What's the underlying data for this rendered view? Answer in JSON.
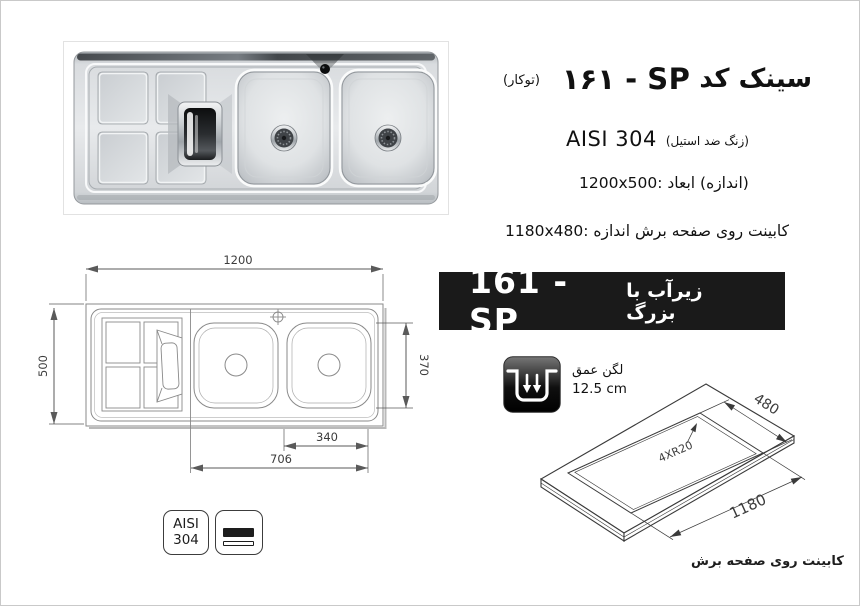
{
  "page": {
    "background": "#ffffff",
    "border_color": "#c9c9c9"
  },
  "header": {
    "product_name": "سینک کد",
    "product_code_fa": "۱۶۱ - SP",
    "mount_type": "(توکار)",
    "steel_grade": "AISI 304",
    "steel_note": "(استیل‎ ضد‎ زنگ)",
    "overall_dims": "1200x500: ابعاد‎ (اندازه)",
    "cutout_dims": "1180x480: اندازه‎ برش‎ صفحه‎ روی‎ کابینت"
  },
  "banner": {
    "code": "161 - SP",
    "feature": "با‎ زیرآب‎ بزرگ",
    "bg": "#1a1a1a",
    "fg": "#ffffff"
  },
  "depth_spec": {
    "label": "عمق‎ لگن",
    "value": "12.5 cm"
  },
  "plan_view": {
    "dim_length": "1200",
    "dim_width": "500",
    "dim_bowl": "370",
    "dim_bowl_inner": "340",
    "dim_bowls_span": "706"
  },
  "cutout_view": {
    "dim_depth": "480",
    "dim_length": "1180",
    "corner_radius": "4XR20",
    "caption": "برش‎ صفحه‎ روی‎ کابینت"
  },
  "badges": {
    "steel_line1": "AISI",
    "steel_line2": "304"
  },
  "colors": {
    "line_art": "#444444",
    "dim_text": "#3c3c3c",
    "steel_light": "#e8eaec",
    "steel_dark": "#aeb3b8"
  }
}
